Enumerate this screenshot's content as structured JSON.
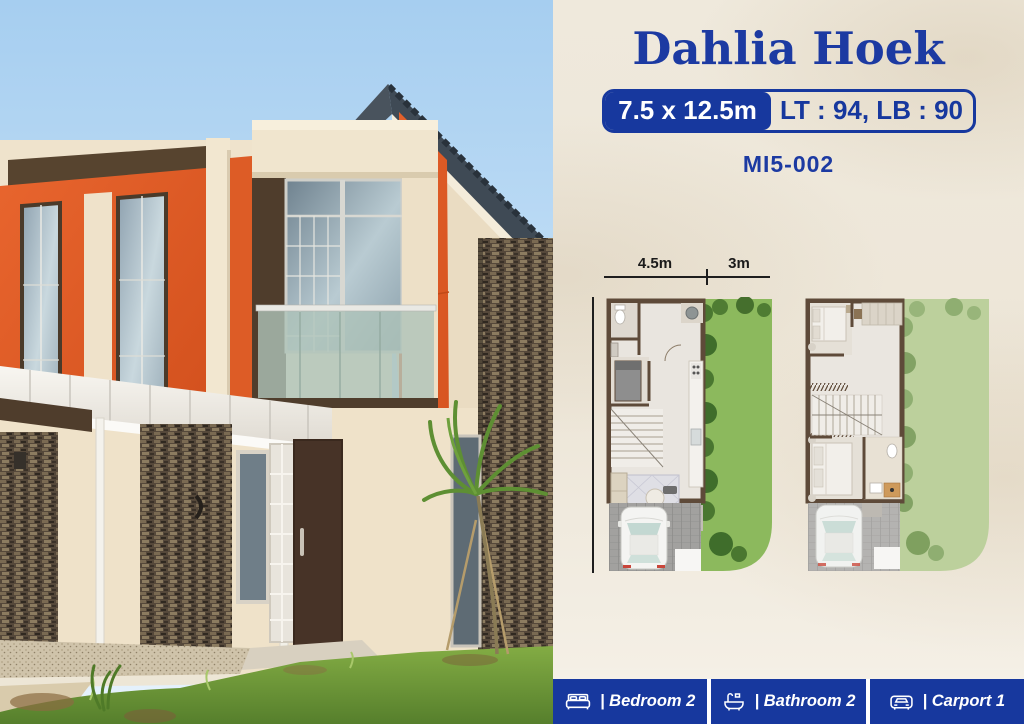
{
  "header": {
    "title": "Dahlia Hoek",
    "size_badge": "7.5 x 12.5m",
    "area_badge": "LT : 94, LB : 90",
    "unit_code": "MI5-002"
  },
  "floorplan": {
    "front_width": "4.5m",
    "garden_width": "3m",
    "depth": "12.5m"
  },
  "features": [
    {
      "icon": "bed-icon",
      "label": "| Bedroom 2"
    },
    {
      "icon": "bath-icon",
      "label": "| Bathroom 2"
    },
    {
      "icon": "car-icon",
      "label": "| Carport 1"
    }
  ],
  "colors": {
    "brand_blue": "#17389E",
    "accent_orange": "#E0602B",
    "cream_background": "#EDE7DA",
    "plan_garden_green": "#8CB95D",
    "plan_garden_green_light": "#BCD09C",
    "wall_brown": "#5E4A39"
  }
}
